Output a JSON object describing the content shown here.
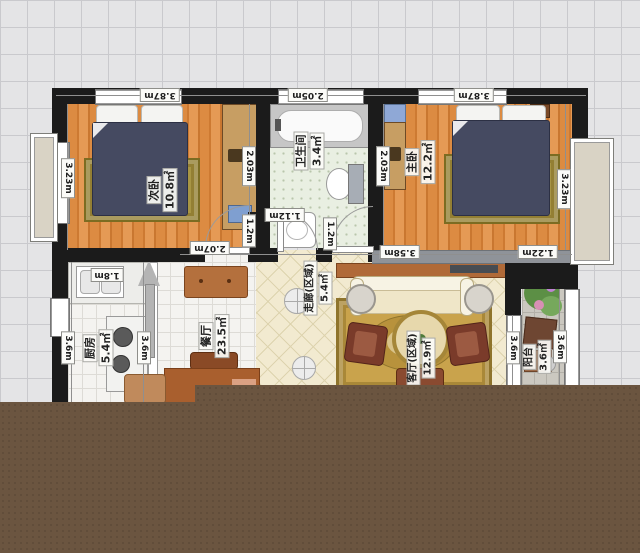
{
  "rooms": [
    {
      "name": "次卧",
      "area": "10.8㎡",
      "dims": {
        "top": "3.87m",
        "left": "3.23m",
        "right": "2.03m",
        "bottom": "2.07m",
        "door": "1.2m"
      }
    },
    {
      "name": "卫生间",
      "area": "3.4㎡",
      "dims": {
        "top": "2.05m",
        "door": "1.12m"
      }
    },
    {
      "name": "主卧",
      "area": "12.2㎡",
      "dims": {
        "top": "3.87m",
        "left": "2.03m",
        "right": "3.23m",
        "bottom": "3.58m",
        "bottom_right": "1.22m",
        "door": "1.2m"
      }
    },
    {
      "name": "厨房",
      "area": "5.4㎡",
      "dims": {
        "top": "1.8m",
        "left": "3.6m",
        "right": "3.6m"
      }
    },
    {
      "name": "餐厅",
      "area": "23.5㎡",
      "dims": {}
    },
    {
      "name": "走廊(区域)",
      "area": "5.4㎡",
      "dims": {}
    },
    {
      "name": "客厅(区域)",
      "area": "12.9㎡",
      "dims": {}
    },
    {
      "name": "阳台",
      "area": "3.6㎡",
      "dims": {
        "left": "3.6m",
        "right": "3.6m"
      }
    }
  ],
  "colors": {
    "background": "#e4e4e6",
    "wall": "#1b1b1b",
    "wood_floor": "#dc8b42",
    "bathroom_floor": "#e9efe2",
    "corridor_floor": "#f2ead0",
    "kitchen_floor": "#f4f3f0",
    "balcony_floor": "#cbc8c0",
    "living_rug": "#c9a34c",
    "bed": "#454a61",
    "sofa": "#f1ead0",
    "overlay_brown": "#6b5540"
  }
}
